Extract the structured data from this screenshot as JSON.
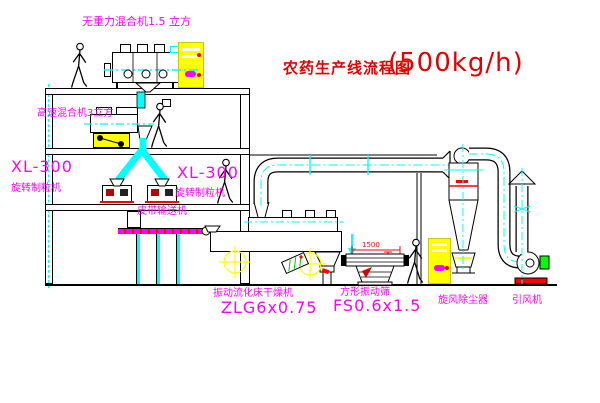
{
  "title": {
    "name": "农药生产线流程图",
    "capacity": "(500kg/h)"
  },
  "equipment": {
    "mixer_top": {
      "label": "无重力混合机1.5 立方"
    },
    "mixer_mid": {
      "label": "高速混合机3立方"
    },
    "granulator_left": {
      "model": "XL-300",
      "label": "旋转制粒机"
    },
    "granulator_right": {
      "model": "XL-300",
      "label": "旋转制粒机"
    },
    "conveyor": {
      "label": "皮带输送机"
    },
    "dryer": {
      "label": "振动流化床干燥机",
      "model": "ZLG6x0.75"
    },
    "screen": {
      "label": "方形振动筛",
      "model": "FS0.6x1.5"
    },
    "cyclone": {
      "label": "旋风除尘器"
    },
    "fan": {
      "label": "引风机"
    }
  },
  "dimensions": {
    "screen_width": "1500"
  },
  "colors": {
    "label": "#ff00ff",
    "title": "#e60000",
    "centerline": "#00ffff",
    "cabinet": "#ffff00",
    "dimension": "#ff0000"
  }
}
